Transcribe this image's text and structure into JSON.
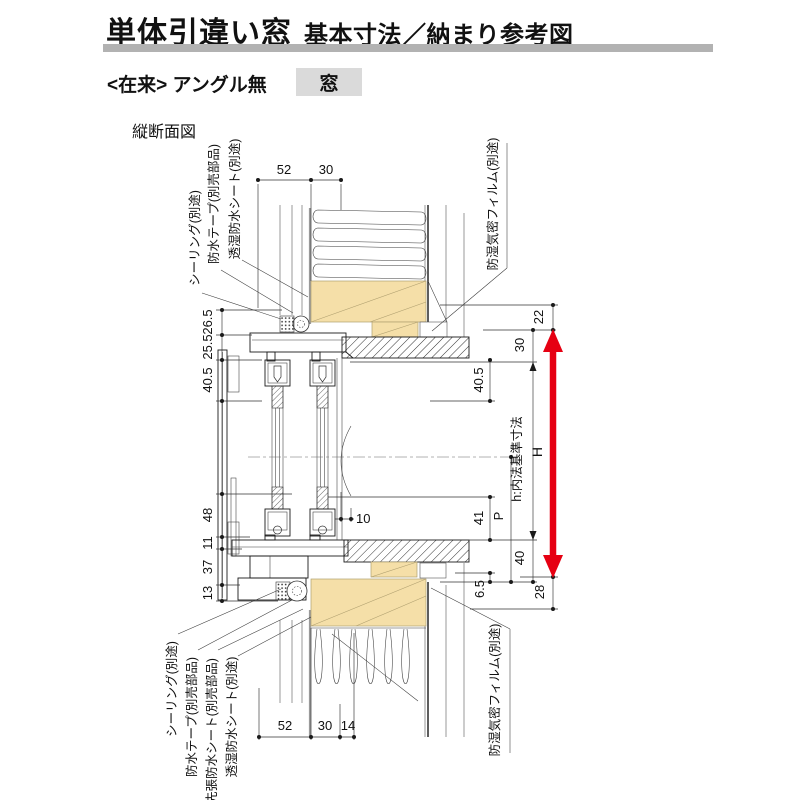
{
  "header": {
    "title_main": "単体引違い窓",
    "title_sub": "基本寸法／納まり参考図"
  },
  "subheader": {
    "construction": "<在来> アングル無",
    "window_tag": "窓"
  },
  "diagram": {
    "caption": "縦断面図",
    "dims": {
      "top": [
        "52",
        "30"
      ],
      "bottom": [
        "52",
        "30",
        "14"
      ],
      "left": [
        "26.5",
        "25.5",
        "40.5",
        "48",
        "11",
        "37",
        "13"
      ],
      "right_inner": [
        "40.5",
        "41",
        "6.5"
      ],
      "p": "P",
      "mid_upper": "30",
      "mid_lower": "40",
      "h_label": "h:内法基準寸法",
      "outer_upper": "22",
      "outer_lower": "28",
      "height_label": "H",
      "meeting_gap": "10"
    },
    "callouts": {
      "top_left": [
        "シーリング(別途)",
        "防水テープ(別売部品)",
        "透湿防水シート(別途)"
      ],
      "top_right": "防湿気密フィルム(別途)",
      "bottom_left": [
        "シーリング(別途)",
        "防水テープ(別売部品)",
        "先張防水シート(別売部品)",
        "透湿防水シート(別途)"
      ],
      "bottom_right": "防湿気密フィルム(別途)"
    },
    "colors": {
      "dimension_red": "#e60012",
      "wood": "#f5dfa8",
      "header_bar": "#b2b2b2",
      "tag_bg": "#dadada"
    }
  }
}
